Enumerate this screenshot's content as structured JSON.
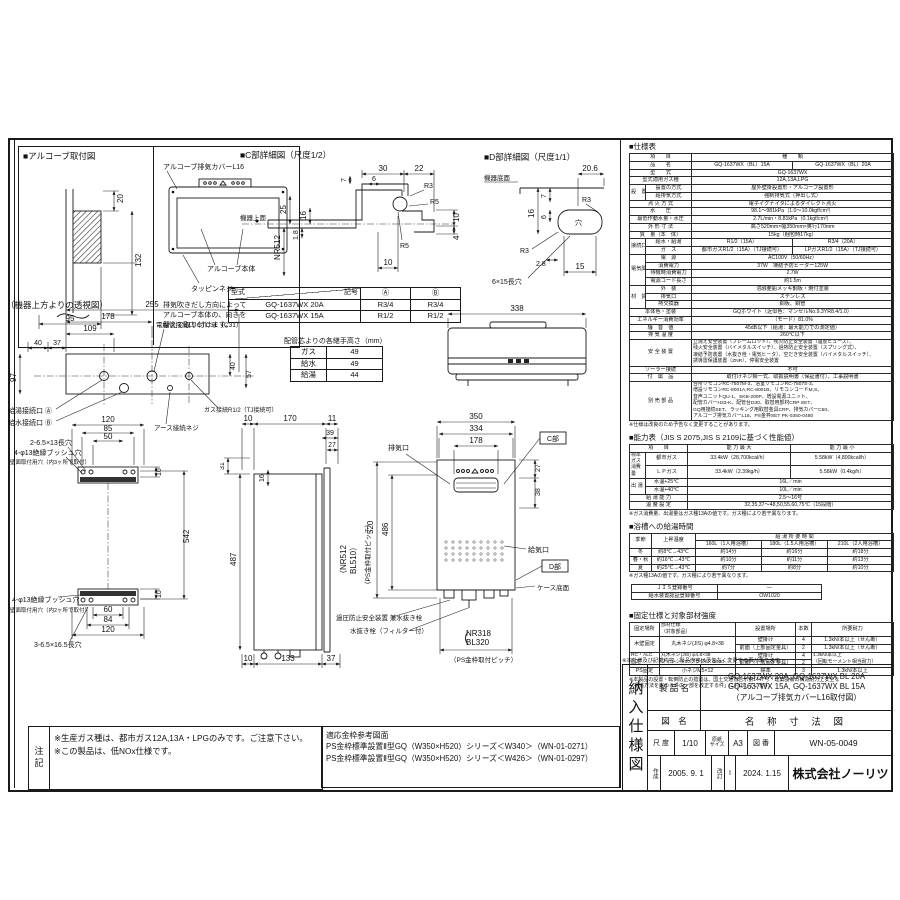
{
  "alcove": {
    "title": "■アルコーブ取付図",
    "cover": "アルコーブ排気カバーL16",
    "body": "アルコーブ本体",
    "screw": "タッピンネジ",
    "note1": "排気吹きだし方向によって",
    "note2": "アルコーブ本体の、向きを",
    "note3": "替えて取り付けます。",
    "d20": "20",
    "d132": "132",
    "d95": "95"
  },
  "detailC": {
    "title": "■C部詳細図（尺度1/2）",
    "face": "機器上面",
    "d30": "30",
    "d22": "22",
    "d6": "6",
    "r3": "R3",
    "r5a": "R5",
    "r5b": "R5",
    "d7": "7",
    "d25": "25",
    "d16": "16",
    "nr": "NR512",
    "d18": "1.8",
    "d10a": "10",
    "d10b": "10",
    "d4": "4"
  },
  "detailD": {
    "title": "■D部詳細図（尺度1/1）",
    "face": "機器底面",
    "d206": "20.6",
    "d16": "16",
    "d6": "6",
    "d7": "7",
    "r3a": "R3",
    "r3b": "R3",
    "d28": "2.8",
    "d15": "15",
    "hole": "穴",
    "slot": "6×15長穴"
  },
  "modelTable": {
    "model": "型式",
    "symbol": "記号",
    "colA": "Ⓐ",
    "colB": "Ⓑ",
    "rows": [
      [
        "GQ-1637WX 20A",
        "R3/4",
        "R3/4"
      ],
      [
        "GQ-1637WX 15A",
        "R1/2",
        "R1/2"
      ]
    ]
  },
  "topView": {
    "title": "（機器上方よりの透視図）",
    "conduit": "電線管接続口 CTC31（C31）",
    "hot": "給湯接続口 Ⓐ",
    "cold": "給水接続口 Ⓑ",
    "gas": "ガス接続R1/2（TJ接続可）",
    "earth": "アース接続ネジ",
    "d255": "255",
    "d178": "178",
    "d109": "109",
    "d40a": "40",
    "d37": "37",
    "d97": "97",
    "d40b": "40",
    "d57": "57"
  },
  "jointTable": {
    "title": "配管芯よりの各継手高さ（mm）",
    "rows": [
      [
        "ガス",
        "49"
      ],
      [
        "給水",
        "49"
      ],
      [
        "給湯",
        "44"
      ]
    ]
  },
  "topOutline": {
    "d338": "338"
  },
  "rearView": {
    "lt0": "2-6.5×13長穴",
    "lt1": "4-φ13絶縁ブッシュ穴",
    "lt2": "壁面取付用穴（内3ヶ所で取付）",
    "lb0": "4-φ13絶縁ブッシュ穴",
    "lb1": "壁面取付用穴（内2ヶ所で取付）",
    "lb2": "3-6.5×16.5長穴",
    "d120t": "120",
    "d85": "85",
    "d50": "50",
    "d10t": "10",
    "d542": "542",
    "d60": "60",
    "d84": "84",
    "d120b": "120",
    "d10b": "10"
  },
  "sideView": {
    "d10t": "10",
    "d170": "170",
    "d11": "11",
    "d39": "39",
    "d27": "27",
    "d16": "16",
    "d31": "31",
    "d487": "487",
    "nr": "（NR512",
    "bl": "BL510）",
    "pitch": "（PS金枠取付ピッチ）",
    "d10b": "10",
    "d133": "133",
    "d37": "37"
  },
  "frontView": {
    "d350": "350",
    "d334": "334",
    "d178": "178",
    "d27": "27",
    "d38": "38",
    "d520": "520",
    "d486": "486",
    "exhaust": "排気口",
    "cref": "C部",
    "intake": "給気口",
    "dref": "D部",
    "caseBottom": "ケース底面",
    "relief": "過圧防止安全装置 兼水抜き栓",
    "drain": "水抜き栓（フィルター付）",
    "paren": "（",
    "nr": "NR318",
    "bl": "BL320",
    "pitch": "（PS金枠取付ピッチ）"
  },
  "spec": {
    "title": "■仕様表",
    "rows": [
      [
        {
          "t": "項　　目",
          "cs": 2,
          "h": 1
        },
        {
          "t": "種　　類",
          "cs": 2,
          "h": 1
        }
      ],
      [
        {
          "t": "品　　名",
          "cs": 2,
          "h": 1
        },
        "GQ-1637WX（BL）15A",
        "GQ-1637WX（BL）20A"
      ],
      [
        {
          "t": "型　　式",
          "cs": 2,
          "h": 1
        },
        {
          "t": "GQ-1637WX",
          "cs": 2
        }
      ],
      [
        {
          "t": "型式適用ガス種",
          "cs": 2,
          "h": 1
        },
        {
          "t": "12A,13A,LPG",
          "cs": 2
        }
      ],
      [
        {
          "t": "設　置",
          "rs": 2,
          "h": 1
        },
        {
          "t": "設置の方式",
          "h": 1
        },
        {
          "t": "屋外壁掛設置形・アルコーブ設置形",
          "cs": 2
        }
      ],
      [
        {
          "t": "給排気方式",
          "h": 1
        },
        {
          "t": "強制排気式（押出し式）",
          "cs": 2
        }
      ],
      [
        {
          "t": "点 火 方 式",
          "cs": 2,
          "h": 1
        },
        {
          "t": "電子イグナイタによるダイレクト点火",
          "cs": 2
        }
      ],
      [
        {
          "t": "水　　圧",
          "cs": 2,
          "h": 1
        },
        {
          "t": "98.1～981kPa｛1.0～10.0kgf/cm²｝",
          "cs": 2
        }
      ],
      [
        {
          "t": "最低作動水量・水圧",
          "cs": 2,
          "h": 1
        },
        {
          "t": "2.7L/min・8.81kPa｛0.1kgf/cm²｝",
          "cs": 2
        }
      ],
      [
        {
          "t": "外 形 寸 法",
          "cs": 2,
          "h": 1
        },
        {
          "t": "高さ520mm×幅350mm×奥行170mm",
          "cs": 2
        }
      ],
      [
        {
          "t": "質　量（本　体）",
          "cs": 2,
          "h": 1
        },
        {
          "t": "15kg（梱包時17kg）",
          "cs": 2
        }
      ],
      [
        {
          "t": "接続口径",
          "rs": 2,
          "h": 1
        },
        {
          "t": "給水・給湯",
          "h": 1
        },
        "R1/2（15A）",
        "R3/4（20A）"
      ],
      [
        {
          "t": "ガ　ス",
          "h": 1
        },
        "都市ガスR1/2（15A）（TJ接続可）",
        "LPガスR1/2（15A）（TJ接続可）"
      ],
      [
        {
          "t": "電気関係",
          "rs": 4,
          "h": 1
        },
        {
          "t": "電　源",
          "h": 1
        },
        {
          "t": "AC100V（50/60Hz）",
          "cs": 2
        }
      ],
      [
        {
          "t": "消費電力",
          "h": 1
        },
        {
          "t": "37W　凍結予防ヒーター125W",
          "cs": 2
        }
      ],
      [
        {
          "t": "待機時消費電力",
          "h": 1
        },
        {
          "t": "2.7W",
          "cs": 2
        }
      ],
      [
        {
          "t": "電源コード長さ",
          "h": 1
        },
        {
          "t": "約1.5m",
          "cs": 2
        }
      ],
      [
        {
          "t": "材　質",
          "rs": 3,
          "h": 1
        },
        {
          "t": "外　装",
          "h": 1
        },
        {
          "t": "溶融亜鉛メッキ鋼板・焼付塗装",
          "cs": 2
        }
      ],
      [
        {
          "t": "排気口",
          "h": 1
        },
        {
          "t": "ステンレス",
          "cs": 2
        }
      ],
      [
        {
          "t": "熱交換器",
          "h": 1
        },
        {
          "t": "銅板、銅管",
          "cs": 2
        }
      ],
      [
        {
          "t": "本体色・塗装",
          "cs": 2,
          "h": 1
        },
        {
          "t": "GQホワイト（近似色：マンセルNo.9.3YR8.4/1.0）",
          "cs": 2
        }
      ],
      [
        {
          "t": "エネルギー消費効率",
          "cs": 2,
          "h": 1
        },
        {
          "t": "（モード）81.0%",
          "cs": 2
        }
      ],
      [
        {
          "t": "騒　音　値",
          "cs": 2,
          "h": 1
        },
        {
          "t": "45dB以下（給湯：最大能力での測定値）",
          "cs": 2
        }
      ],
      [
        {
          "t": "排 気 温 度",
          "cs": 2,
          "h": 1
        },
        {
          "t": "260℃以下",
          "cs": 2
        }
      ],
      [
        {
          "t": "安 全 装 置",
          "cs": 2,
          "h": 1
        },
        {
          "t": "立消え安全装置（フレームロッド）、残火防止安全装置（温度ヒューズ）、\n残火安全装置（バイメタルスイッチ）、過熱防止安全装置（スプリング式）、\n凍結予防装置（水抜き栓・電気ヒータ）、空だき安全装置（バイメタルスイッチ）、\n誘導雷保護装置（ZNR）、停電安全装置",
          "cs": 2,
          "cls": "pre"
        }
      ],
      [
        {
          "t": "ソーラー接続",
          "cs": 2,
          "h": 1
        },
        {
          "t": "不可",
          "cs": 2
        }
      ],
      [
        {
          "t": "付　属　品",
          "cs": 2,
          "h": 1
        },
        {
          "t": "取付けネジ類一式、取扱説明書（保証書付）、工事説明書",
          "cs": 2
        }
      ],
      [
        {
          "t": "別 売 部 品",
          "cs": 2,
          "h": 1
        },
        {
          "t": "台所リモコンRC-7507M-3、浴室リモコンRC-7507S-3、\n増設リモコンRC-8001A,RC-8001B、リモコンコードM,S、\n音声ユニットQU-1、SKB-200P、増設電源ユニット、\n配管カバーH33-K、配管台D30、取替用部材CRP SET、\nGQ用接続SET、ラッキング用取替金具CRP、排気カバーC50、\nアルコーブ排気カバーL16、PS金枠SET PK-0350-0480",
          "cs": 2,
          "cls": "pre"
        }
      ]
    ],
    "note": "※仕様は改良のため予告なく変更することがあります。"
  },
  "capacity": {
    "title": "■能力表（JIS S 2075,JIS S 2109に基づく性能値）",
    "rows": [
      [
        {
          "t": "項　　目",
          "cs": 2,
          "h": 1
        },
        {
          "t": "能 力 最 大",
          "h": 1
        },
        {
          "t": "能 力 最 小",
          "h": 1
        }
      ],
      [
        {
          "t": "標準ガス\n消費量",
          "rs": 2,
          "h": 1,
          "cls": "pre"
        },
        {
          "t": "都市ガス",
          "h": 1
        },
        "33.4kW（28,700kcal/h）",
        "5.58kW（4,800kcal/h）"
      ],
      [
        {
          "t": "ＬＰガス",
          "h": 1
        },
        "33.4kW（2.39kg/h）",
        "5.58kW（0.4kg/h）"
      ],
      [
        {
          "t": "出 湯 量",
          "rs": 2,
          "h": 1
        },
        {
          "t": "水温+25℃",
          "h": 1
        },
        {
          "t": "16L／min",
          "cs": 2
        }
      ],
      [
        {
          "t": "水温+40℃",
          "h": 1
        },
        {
          "t": "10L／min",
          "cs": 2
        }
      ],
      [
        {
          "t": "給 湯 能 力",
          "cs": 2,
          "h": 1
        },
        {
          "t": "2.5～16号",
          "cs": 2
        }
      ],
      [
        {
          "t": "温 度 設 定",
          "cs": 2,
          "h": 1
        },
        {
          "t": "32,35,37～48,50,55,60,75℃（15段階）",
          "cs": 2
        }
      ]
    ],
    "note": "※ガス消費量、出湯量はガス種13Aの値です。ガス種により若干異なります。"
  },
  "bath": {
    "title": "■浴槽への給湯時間",
    "rows": [
      [
        {
          "t": "季節",
          "rs": 2,
          "h": 1
        },
        {
          "t": "上昇温度",
          "rs": 2,
          "h": 1
        },
        {
          "t": "給 湯 所 要 時 間",
          "cs": 3,
          "h": 1
        }
      ],
      [
        {
          "t": "160L（1人用浴槽）",
          "h": 1
        },
        {
          "t": "180L（1.5人用浴槽）",
          "h": 1
        },
        {
          "t": "210L（2人用浴槽）",
          "h": 1
        }
      ],
      [
        {
          "t": "冬",
          "h": 1
        },
        {
          "t": "約8℃→43℃",
          "h": 1
        },
        "約14分",
        "約16分",
        "約18分"
      ],
      [
        {
          "t": "春・秋",
          "h": 1
        },
        {
          "t": "約16℃→43℃",
          "h": 1
        },
        "約10分",
        "約11分",
        "約13分"
      ],
      [
        {
          "t": "夏",
          "h": 1
        },
        {
          "t": "約25℃→43℃",
          "h": 1
        },
        "約7分",
        "約8分",
        "約10分"
      ]
    ],
    "note": "※ガス種13Aの値です。ガス種により若干異なります。"
  },
  "cert": {
    "rows": [
      [
        {
          "t": "ＪＩＳ登録番号",
          "h": 1
        },
        "—"
      ],
      [
        {
          "t": "給水装置認証登録番号",
          "h": 1
        },
        "OW1020"
      ]
    ]
  },
  "fixing": {
    "title": "■固定仕様と対象部材強度",
    "rows": [
      [
        {
          "t": "固定場所",
          "h": 1
        },
        {
          "t": "部材仕様\n（対象部品）",
          "h": 1,
          "cls": "pre"
        },
        {
          "t": "設置場所",
          "h": 1
        },
        {
          "t": "本数",
          "h": 1
        },
        {
          "t": "所要耐力",
          "h": 1
        }
      ],
      [
        {
          "t": "木壁固定",
          "rs": 2,
          "h": 1
        },
        {
          "t": "丸木ネジ(JIS) φ4.8×38",
          "rs": 2
        },
        "壁掛け",
        "4",
        "1.3kN/本以上（せん断）"
      ],
      [
        "前面（上部固定金具）",
        "2",
        "1.3kN/本以上（せん断）"
      ],
      [
        {
          "t": "RC・ALC\n固定",
          "rs": 2,
          "h": 1,
          "cls": "pre"
        },
        {
          "t": "丸木ネジ(JIS) φ4.8×38\nフィッシャープラグSX 6X30",
          "rs": 2,
          "cls": "pre"
        },
        "壁掛け",
        "4",
        {
          "t": "1.3kN/本以上\n（回転モーメント相当耐力）",
          "rs": 2,
          "cls": "pre"
        }
      ],
      [
        "前面（上部固定金具）",
        "2"
      ],
      [
        {
          "t": "PS固定",
          "h": 1
        },
        "小ネジM5×12",
        "標準",
        "3",
        "1.3kN/本以上"
      ]
    ],
    "note": "※本製品の設置・転倒防止の措置は、国土交通省告示第1447号「建築設備の構造耐力上安全な\n　構造方法を定める件の一部を改正する件」に対応しています。"
  },
  "titleBlock": {
    "note": "※本仕様及び記載内容、製品内容は予告なく変更する事があります。",
    "vertical": "納入仕様図",
    "productLabel": "製 品 名",
    "product1": "GQ-1637WX 20A, GQ-1637WX BL 20A",
    "product2": "GQ-1637WX 15A, GQ-1637WX BL 15A",
    "product3": "（アルコーブ排気カバーL16取付図）",
    "drawingLabel": "図　名",
    "drawingName": "名 称 寸 法 図",
    "scaleLabel": "尺 度",
    "scale": "1/10",
    "sizeLabel": "原紙\nサイズ",
    "size": "A3",
    "numberLabel": "図 番",
    "number": "WN-05-0049",
    "createdLabel": "作成",
    "created": "2005. 9. 1",
    "revLabel": "改訂",
    "revMark": "I",
    "revised": "2024. 1.15",
    "company": "株式会社ノーリツ"
  },
  "notes": {
    "label": "注記",
    "line1": "※生産ガス種は、都市ガス12A,13A・LPGのみです。ご注意下さい。",
    "line2": "※この製品は、低NOx仕様です。"
  },
  "psFrame": {
    "title": "適応金枠参考図面",
    "line1": "PS金枠標準設置Ⅱ型GQ（W350×H520）シリーズ＜W340＞（WN-01-0271）",
    "line2": "PS金枠標準設置Ⅱ型GQ（W350×H520）シリーズ＜W426＞（WN-01-0297）"
  }
}
